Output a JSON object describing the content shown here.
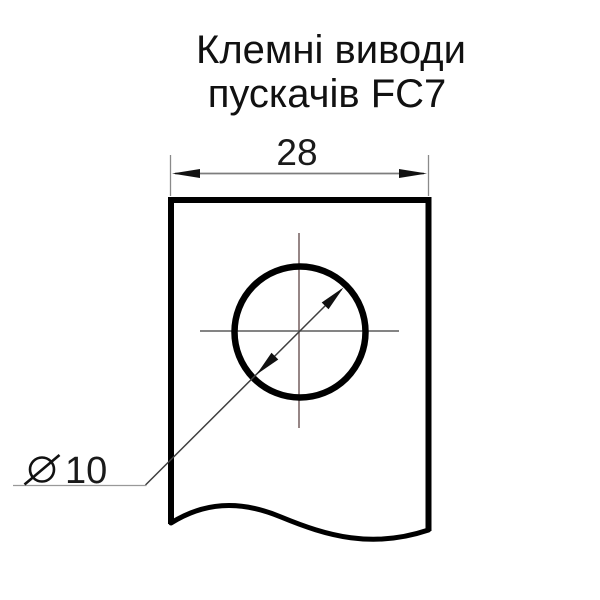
{
  "title": {
    "line1": "Клемні виводи",
    "line2": "пускачів FC7"
  },
  "dimensions": {
    "width": {
      "value": "28"
    },
    "diameter": {
      "symbol": "⌀",
      "value": "10",
      "label": "⌀10"
    }
  },
  "colors": {
    "outline": "#000000",
    "dimension_line": "#7d7d7d",
    "extension_line": "#8a8a8a",
    "leader_line": "#999999",
    "diagonal_line": "#3f3f3f",
    "arrow_fill": "#111111",
    "centerline_vertical": "#6a5252",
    "centerline_horizontal": "#5c5c5c",
    "background": "#ffffff",
    "text": "#111111"
  }
}
